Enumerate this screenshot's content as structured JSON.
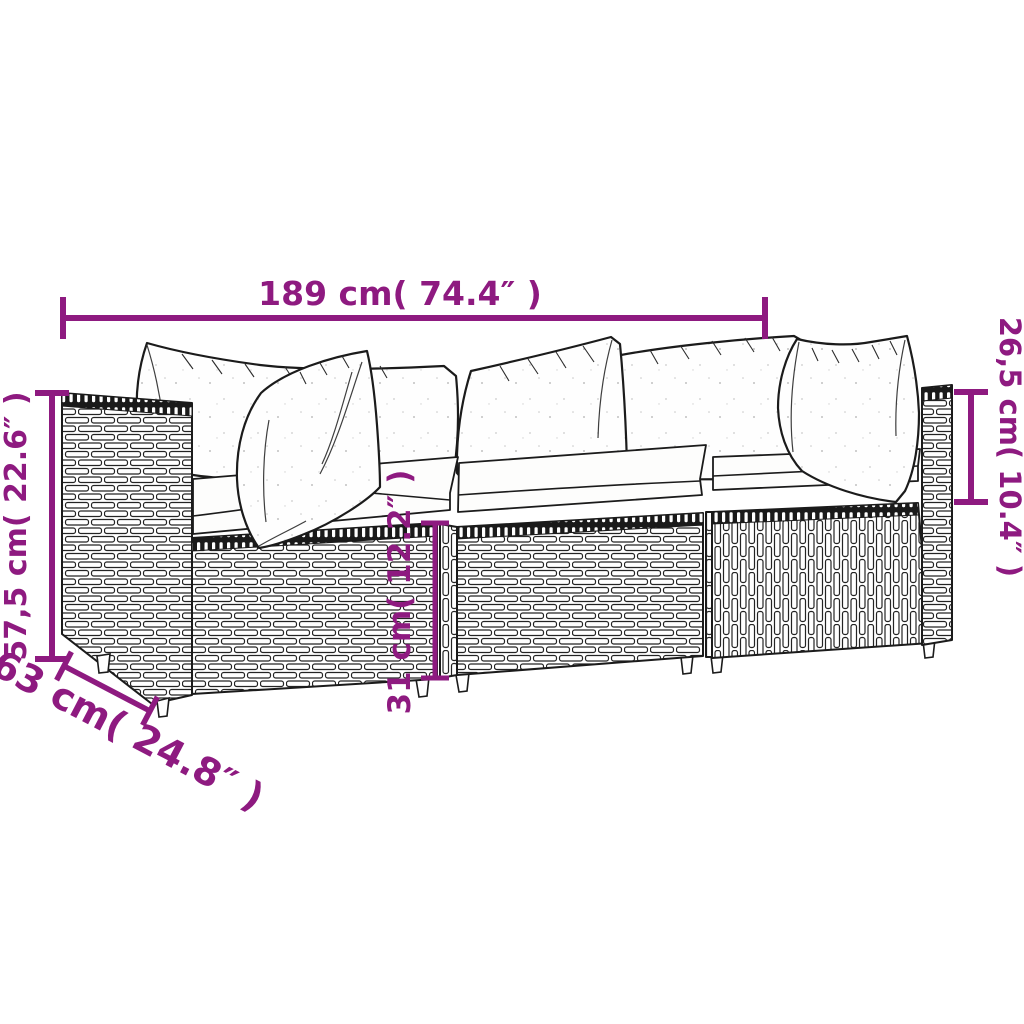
{
  "diagram": {
    "type": "product-dimension-diagram",
    "subject": "3-piece poly rattan garden lounge sofa set with white cushions",
    "accent_color": "#8e1a80",
    "outline_color": "#1b1b1b",
    "background_color": "#ffffff"
  },
  "dimensions": {
    "width": {
      "label": "189 cm( 74.4″ )",
      "meaning": "total width"
    },
    "height": {
      "label": "57,5 cm( 22.6″ )",
      "meaning": "total height"
    },
    "back_height": {
      "label": "26,5 cm( 10.4″ )",
      "meaning": "backrest height above seat"
    },
    "base_height": {
      "label": "31 cm( 12.2″ )",
      "meaning": "seat base height"
    },
    "depth": {
      "label": "63 cm( 24.8″ )",
      "meaning": "depth"
    }
  }
}
